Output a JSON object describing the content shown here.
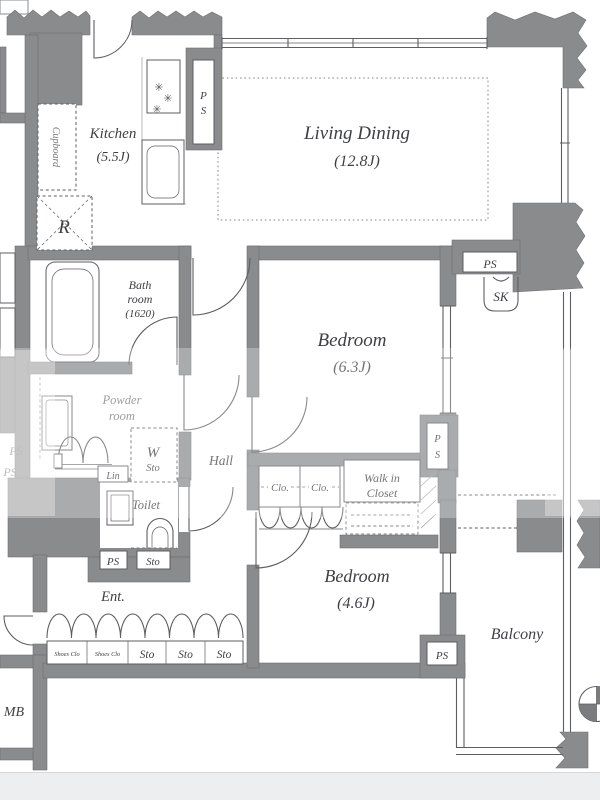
{
  "colors": {
    "wall": "#8a8b8d",
    "edge": "#6f7073",
    "line": "#5d5e62",
    "softline": "#9b9c9f",
    "text": "#3f4044",
    "softtext": "#77787c",
    "strip": "#eceef0"
  },
  "icons": {
    "burner": "✳"
  },
  "rooms": {
    "kitchen": "Kitchen",
    "kitchen_size": "(5.5J)",
    "living": "Living Dining",
    "living_size": "(12.8J)",
    "bedroom1": "Bedroom",
    "bedroom1_size": "(6.3J)",
    "bedroom2": "Bedroom",
    "bedroom2_size": "(4.6J)",
    "bath1": "Bath",
    "bath2": "room",
    "bath3": "(1620)",
    "powder1": "Powder",
    "powder2": "room",
    "toilet": "Toilet",
    "hall": "Hall",
    "ent": "Ent.",
    "balcony": "Balcony",
    "walkin1": "Walk in",
    "walkin2": "Closet"
  },
  "fixtures": {
    "cupboard": "Cupboard",
    "fridge": "R",
    "ps": "PS",
    "ps_p": "P",
    "ps_s": "S",
    "sk": "SK",
    "lin": "Lin",
    "w": "W",
    "sto": "Sto",
    "clo": "Clo.",
    "mb": "MB"
  },
  "storage_row": [
    "Shoes Clo",
    "Shoes Clo",
    "Sto",
    "Sto",
    "Sto"
  ]
}
